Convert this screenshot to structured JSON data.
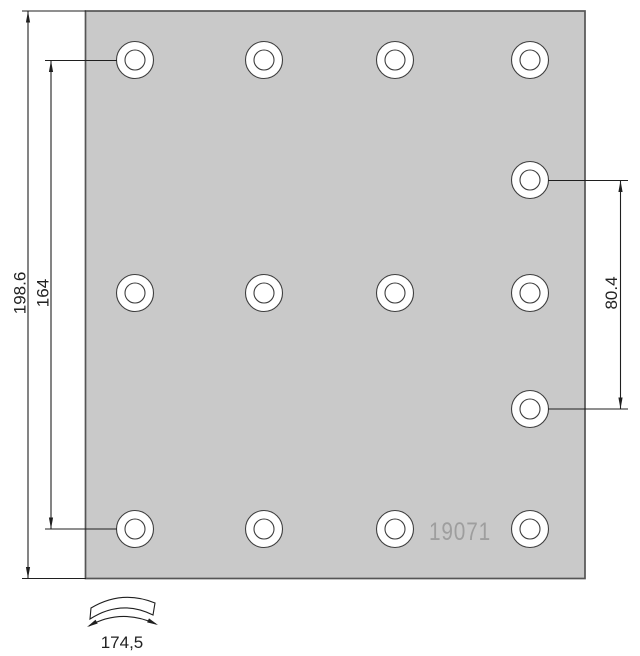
{
  "drawing": {
    "part_number": "19071",
    "dimension_labels": {
      "overall_height": "198.6",
      "rivet_span_height": "164",
      "right_rivet_spacing": "80.4",
      "arc_width": "174,5"
    },
    "colors": {
      "background": "#ffffff",
      "plate_fill": "#c9c9c9",
      "plate_border": "#555555",
      "line": "#1f1f1f",
      "hole_fill": "#ffffff",
      "hole_stroke": "#3f3f3f",
      "part_number_text": "#9e9e9e"
    },
    "plate": {
      "x": 85.5,
      "y": 11,
      "width": 499.5,
      "height": 567.5
    },
    "holes": {
      "outer_radius": 18.5,
      "inner_radius": 10,
      "columns_x": [
        135,
        264,
        395,
        530
      ],
      "rows_y": [
        60,
        293,
        529
      ],
      "extra_right_holes": {
        "x": 530,
        "ys": [
          180,
          409
        ]
      }
    }
  }
}
